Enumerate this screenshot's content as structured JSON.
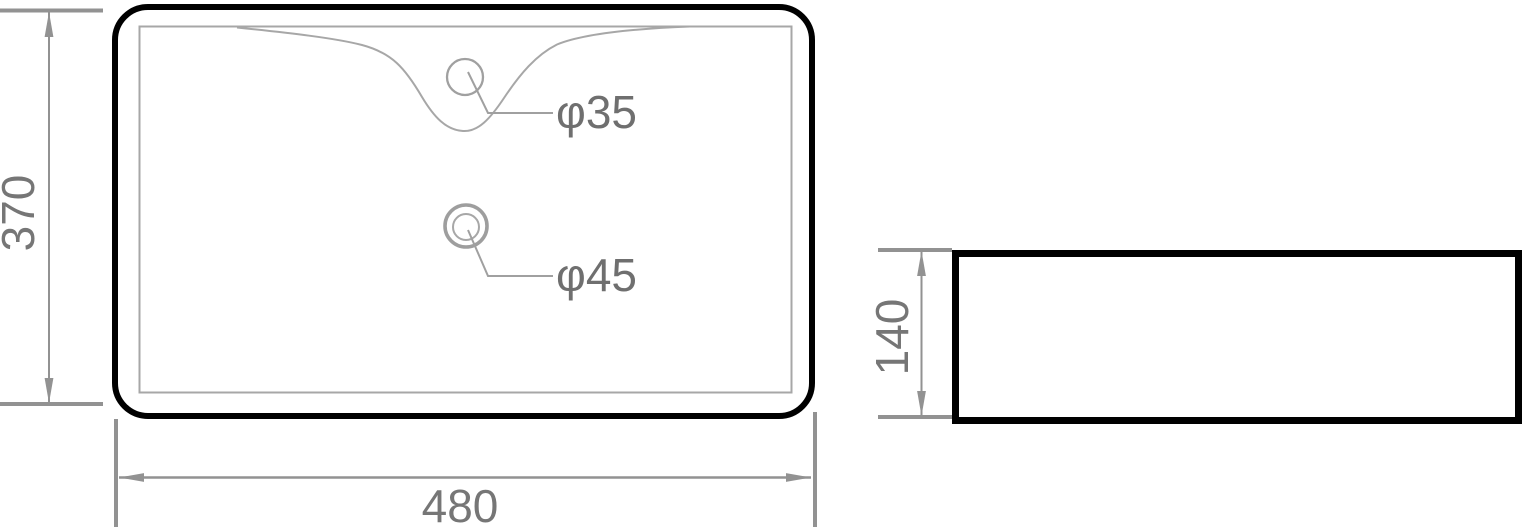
{
  "labels": {
    "top_view_height": "370",
    "top_view_width": "480",
    "side_view_height": "140",
    "faucet_hole_diameter": "φ35",
    "drain_hole_diameter": "φ45"
  },
  "colors": {
    "outline_black": "#000000",
    "thin_line_gray": "#a7a7a7",
    "dimension_gray": "#929292",
    "text_gray": "#767676",
    "background": "#ffffff"
  }
}
